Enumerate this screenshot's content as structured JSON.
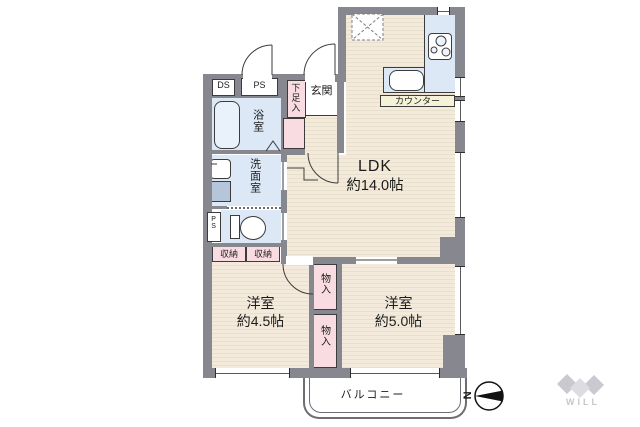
{
  "plan_labels": {
    "ldk_name": "LDK",
    "ldk_size": "約14.0帖",
    "room1_name": "洋室",
    "room1_size": "約4.5帖",
    "room2_name": "洋室",
    "room2_size": "約5.0帖",
    "bathroom": "浴室",
    "washroom": "洗面室",
    "entrance": "玄関",
    "shoe_cabinet": "下足入",
    "counter": "カウンター",
    "balcony": "バルコニー",
    "closet1": "収納",
    "closet2": "収納",
    "storage1": "物入",
    "storage2": "物入",
    "duct_ds": "DS",
    "duct_ps": "PS",
    "toilet_ps": "PS"
  },
  "compass": {
    "north_label": "N"
  },
  "logo": {
    "text": "WILL"
  },
  "colors": {
    "wall": "#87878f",
    "floor_cream": "#f3eadb",
    "wet_blue": "#dce8f5",
    "closet_pink": "#f8dce1",
    "counter_cream": "#f6f2d7",
    "logo_gray": "#c9c9d0"
  }
}
